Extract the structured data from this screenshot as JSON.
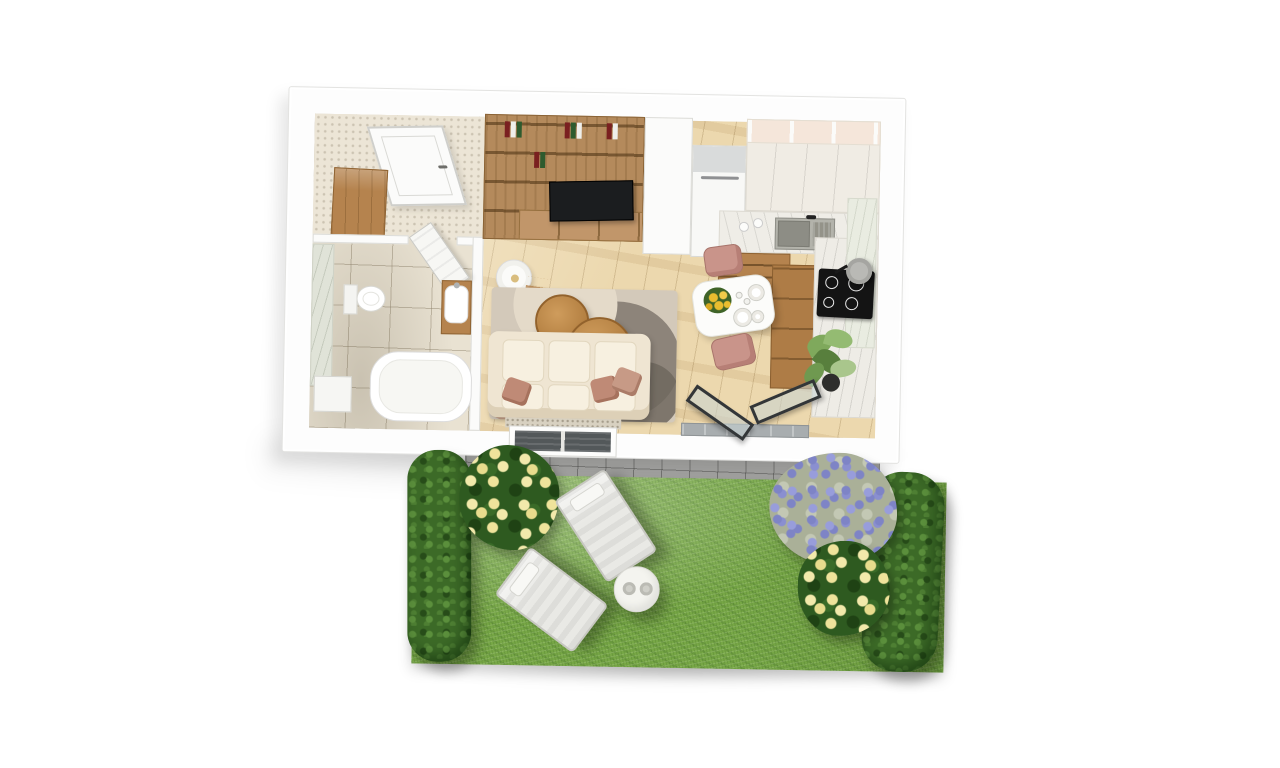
{
  "scene": {
    "kind": "3d-floorplan-render",
    "description": "Top-down 3D render of a small studio apartment with adjoining garden",
    "background": "#ffffff"
  },
  "apartment": {
    "rooms": [
      {
        "name": "entry-hall",
        "floor": "speckled beige tile",
        "items": [
          "front door",
          "wooden wardrobe",
          "open interior door"
        ]
      },
      {
        "name": "bathroom",
        "floor": "beige stone tile",
        "items": [
          "wall-hung toilet",
          "washbasin vanity",
          "bathtub",
          "washing machine",
          "marble wall panel"
        ]
      },
      {
        "name": "living-room",
        "floor": "light oak planks",
        "items": [
          "bookshelf media wall",
          "television",
          "media cabinet",
          "floor lamp",
          "ladder shelf",
          "area rug",
          "round coffee tables",
          "cream sofa with rose pillows",
          "window"
        ]
      },
      {
        "name": "kitchen-dining",
        "floor": "light oak planks",
        "items": [
          "refrigerator",
          "tall white cabinets",
          "marble countertop",
          "sink with faucet",
          "wood drawer cabinets",
          "induction cooktop with pot",
          "dining table with flowers and plates",
          "two rose dining chairs",
          "potted plant",
          "open patio door",
          "marble window sill"
        ]
      }
    ]
  },
  "garden": {
    "elements": [
      "paved patio strip",
      "lawn",
      "left hedge",
      "right hedge",
      "yellow rose bush left",
      "lavender bush",
      "yellow rose bush right",
      "sun lounger",
      "sun lounger",
      "round side table with two cups"
    ]
  },
  "labels": {
    "building": "Apartment",
    "front_door": "Front door",
    "wardrobe": "Wardrobe",
    "bath_door": "Bathroom door (open)",
    "bathroom": "Bathroom",
    "toilet": "Toilet",
    "vanity": "Washbasin vanity",
    "bathtub": "Bathtub",
    "washer": "Washing machine",
    "bookshelf": "Bookshelf media wall",
    "tv": "Television",
    "lamp": "Floor lamp",
    "rug": "Area rug",
    "coffee_table": "Coffee table",
    "sofa": "Sofa",
    "window_back": "Window",
    "fridge": "Refrigerator",
    "cabinets": "Kitchen cabinets",
    "counter": "Marble countertop",
    "sink": "Kitchen sink",
    "cooktop": "Induction cooktop",
    "pot": "Cooking pot",
    "dining_table": "Dining table",
    "chair": "Dining chair",
    "plant": "Potted plant",
    "patio_door": "Patio door (open)",
    "pavers": "Paved patio",
    "grass": "Lawn",
    "hedge": "Hedge",
    "roses": "Yellow rose bush",
    "lavender": "Lavender bush",
    "lounger": "Sun lounger",
    "garden_table": "Garden side table"
  },
  "colors": {
    "background": "#ffffff",
    "walls": "#fdfdfd",
    "wood_furniture": "#b5834e",
    "wood_floor": "#ecd8ae",
    "tile_floor": "#e9e2d2",
    "marble": "#efede7",
    "sofa_cream": "#efe5d2",
    "pillow_rose": "#bf8a76",
    "chair_rose": "#c9948a",
    "tv_black": "#1b1d1f",
    "cooktop_black": "#141414",
    "grass_green": "#77a746",
    "hedge_green": "#3c6a27",
    "lavender_purple": "#7e84c6",
    "rose_yellow": "#f2e9ab",
    "paver_gray": "#a5a5a3"
  }
}
